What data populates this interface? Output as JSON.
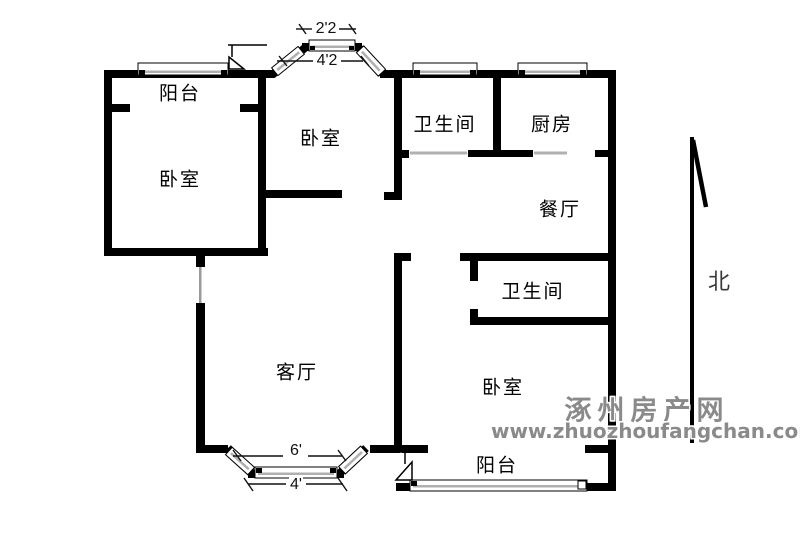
{
  "plan": {
    "rooms": [
      {
        "id": "balcony-top",
        "label": "阳台"
      },
      {
        "id": "bedroom-left",
        "label": "卧室"
      },
      {
        "id": "bedroom-top",
        "label": "卧室"
      },
      {
        "id": "bathroom-top",
        "label": "卫生间"
      },
      {
        "id": "kitchen",
        "label": "厨房"
      },
      {
        "id": "dining-room",
        "label": "餐厅"
      },
      {
        "id": "bathroom-middle",
        "label": "卫生间"
      },
      {
        "id": "living-room",
        "label": "客厅"
      },
      {
        "id": "bedroom-right",
        "label": "卧室"
      },
      {
        "id": "balcony-bottom",
        "label": "阳台"
      }
    ],
    "dimensions": {
      "bay_top_inner": "2'2",
      "bay_top_outer": "4'2",
      "bay_bottom_inner": "6'",
      "bay_bottom_outer": "4'"
    },
    "compass": {
      "label": "北"
    },
    "watermark": {
      "line1": "涿州房产网",
      "line2": "www.zhuozhoufangchan.com"
    },
    "colors": {
      "wall": "#000000",
      "window_glass": "#b0b0b0",
      "watermark": "#8a8a8a"
    }
  }
}
